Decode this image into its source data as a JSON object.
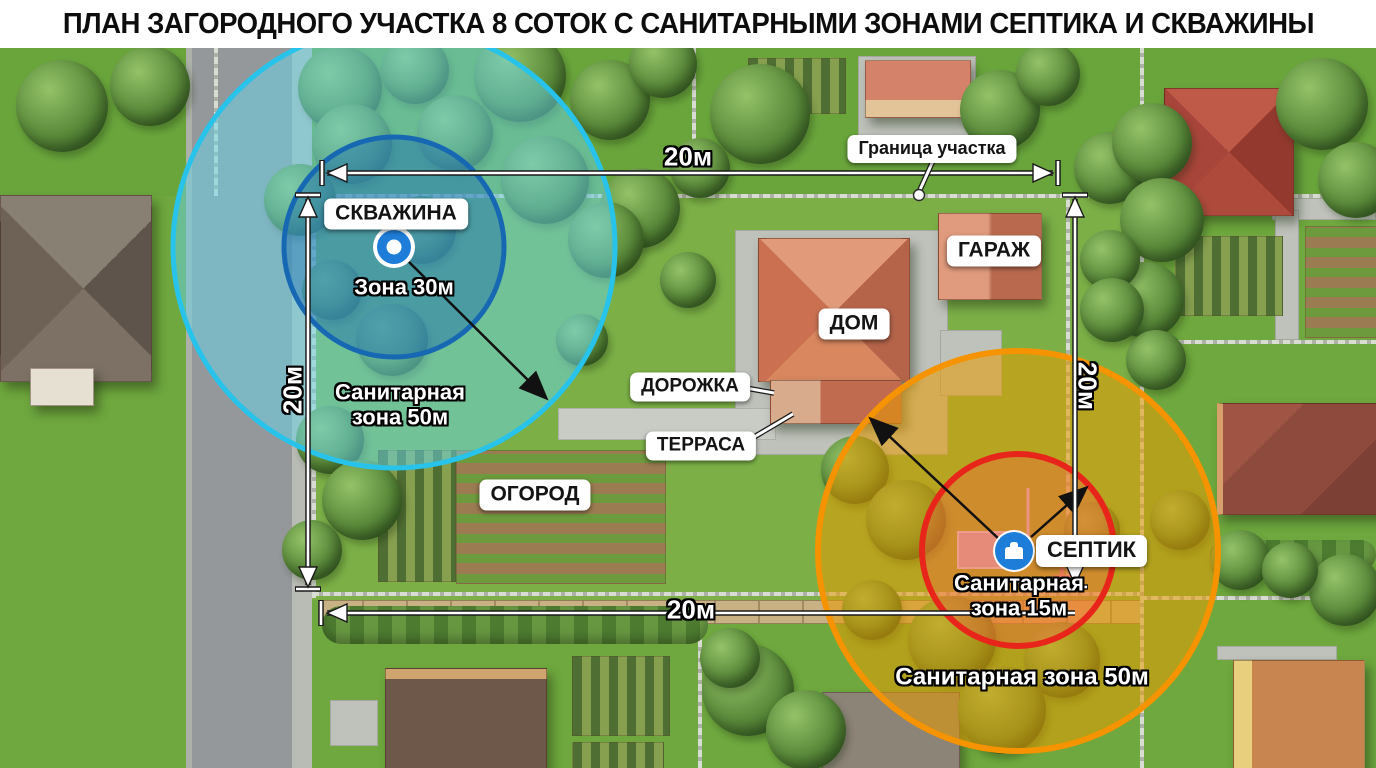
{
  "title": "ПЛАН ЗАГОРОДНОГО УЧАСТКА 8 СОТОК С САНИТАРНЫМИ ЗОНАМИ СЕПТИКА И СКВАЖИНЫ",
  "map": {
    "boundary_label": "Граница участка",
    "labels": {
      "well": "СКВАЖИНА",
      "garage": "ГАРАЖ",
      "house": "ДОМ",
      "path": "ДОРОЖКА",
      "terrace": "ТЕРРАСА",
      "garden": "ОГОРОД",
      "septic": "СЕПТИК"
    },
    "zones": {
      "well": {
        "inner_label": "Зона 30м",
        "outer_label_line1": "Санитарная",
        "outer_label_line2": "зона 50м",
        "inner_radius_m": 30,
        "outer_radius_m": 50,
        "inner_color": "#1668b2",
        "outer_color": "#27c3ea"
      },
      "septic": {
        "inner_label_line1": "Санитарная",
        "inner_label_line2": "зона 15м",
        "outer_label": "Санитарная зона 50м",
        "inner_radius_m": 15,
        "outer_radius_m": 50,
        "inner_color": "#e8251a",
        "outer_color": "#f59300"
      }
    },
    "dimensions": {
      "top": "20м",
      "bottom": "20м",
      "left": "20м",
      "right": "20м"
    },
    "icons": {
      "well": "well-marker-icon",
      "septic": "septic-tank-icon"
    }
  }
}
